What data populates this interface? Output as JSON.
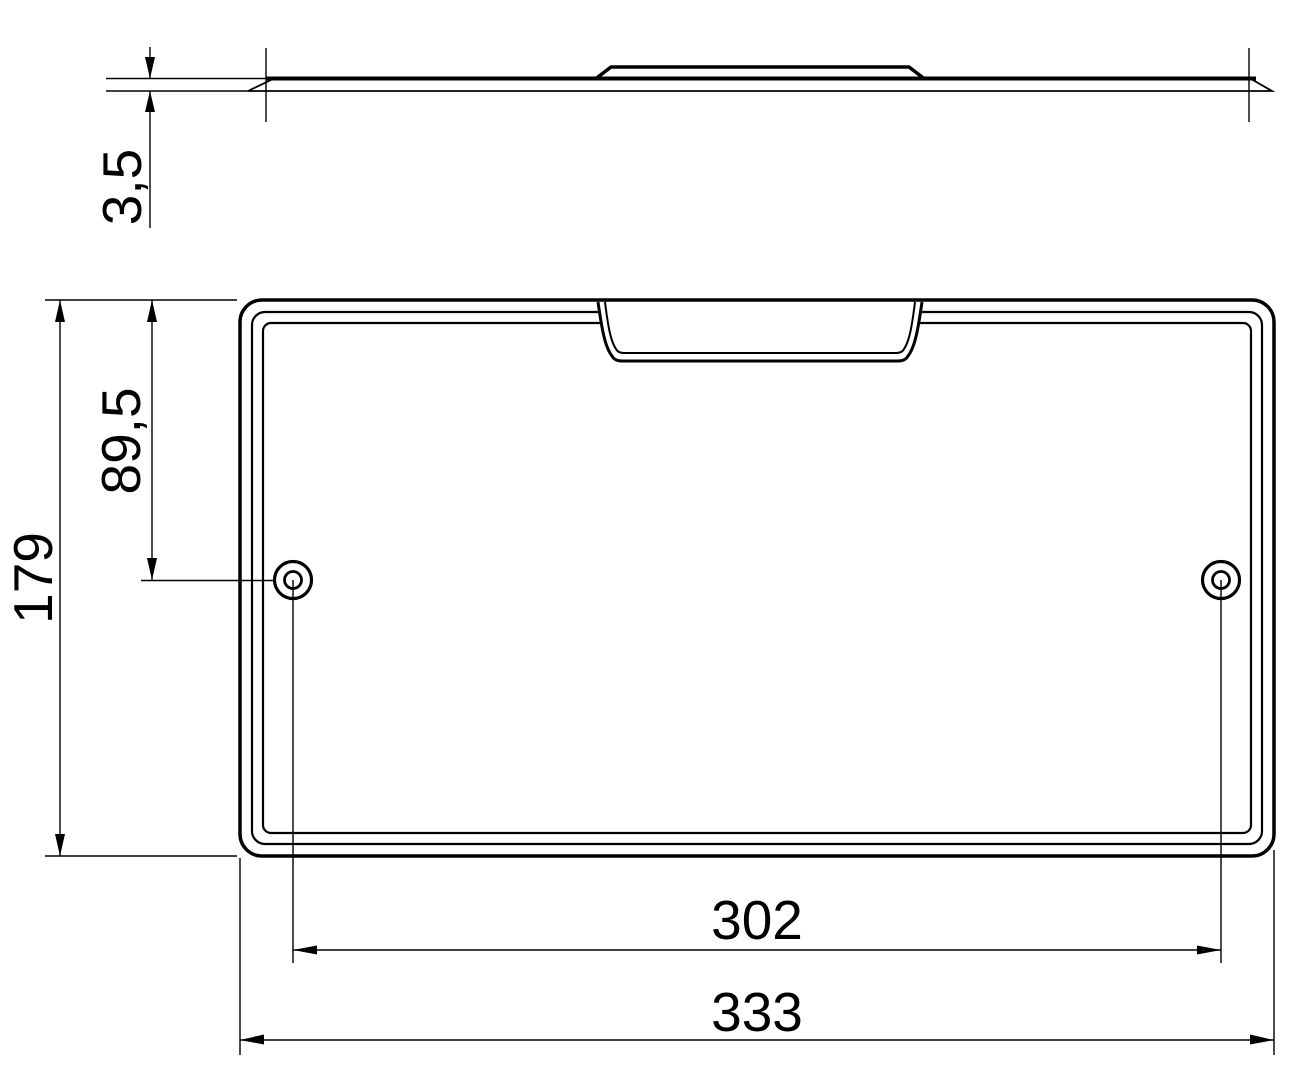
{
  "colors": {
    "ink": "#000000",
    "background": "#ffffff"
  },
  "dimensions": {
    "thickness": "3,5",
    "plate_height": "179",
    "hole_center_from_top": "89,5",
    "hole_spacing": "302",
    "plate_width": "333"
  }
}
